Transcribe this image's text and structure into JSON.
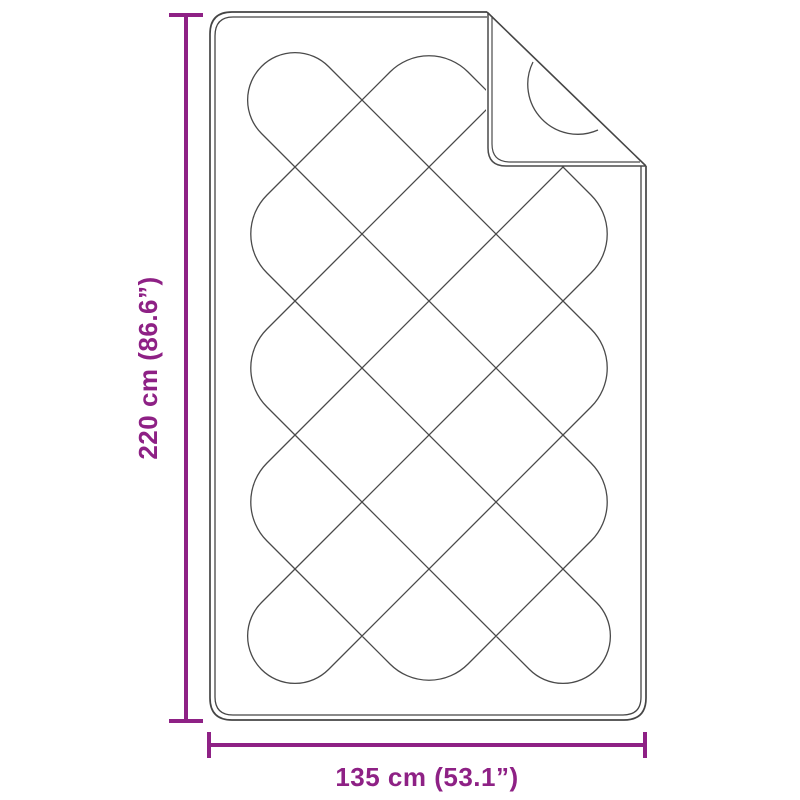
{
  "diagram": {
    "kind": "product-dimension-diagram",
    "subject": "quilted blanket with folded corner"
  },
  "dimensions": {
    "height": {
      "label": "220 cm (86.6”)",
      "value_cm": 220,
      "value_inch": 86.6
    },
    "width": {
      "label": "135 cm (53.1”)",
      "value_cm": 135,
      "value_inch": 53.1
    }
  },
  "colors": {
    "accent": "#8E2185",
    "outline": "#454545",
    "stitch": "#4A4A4A",
    "background": "#FFFFFF"
  }
}
